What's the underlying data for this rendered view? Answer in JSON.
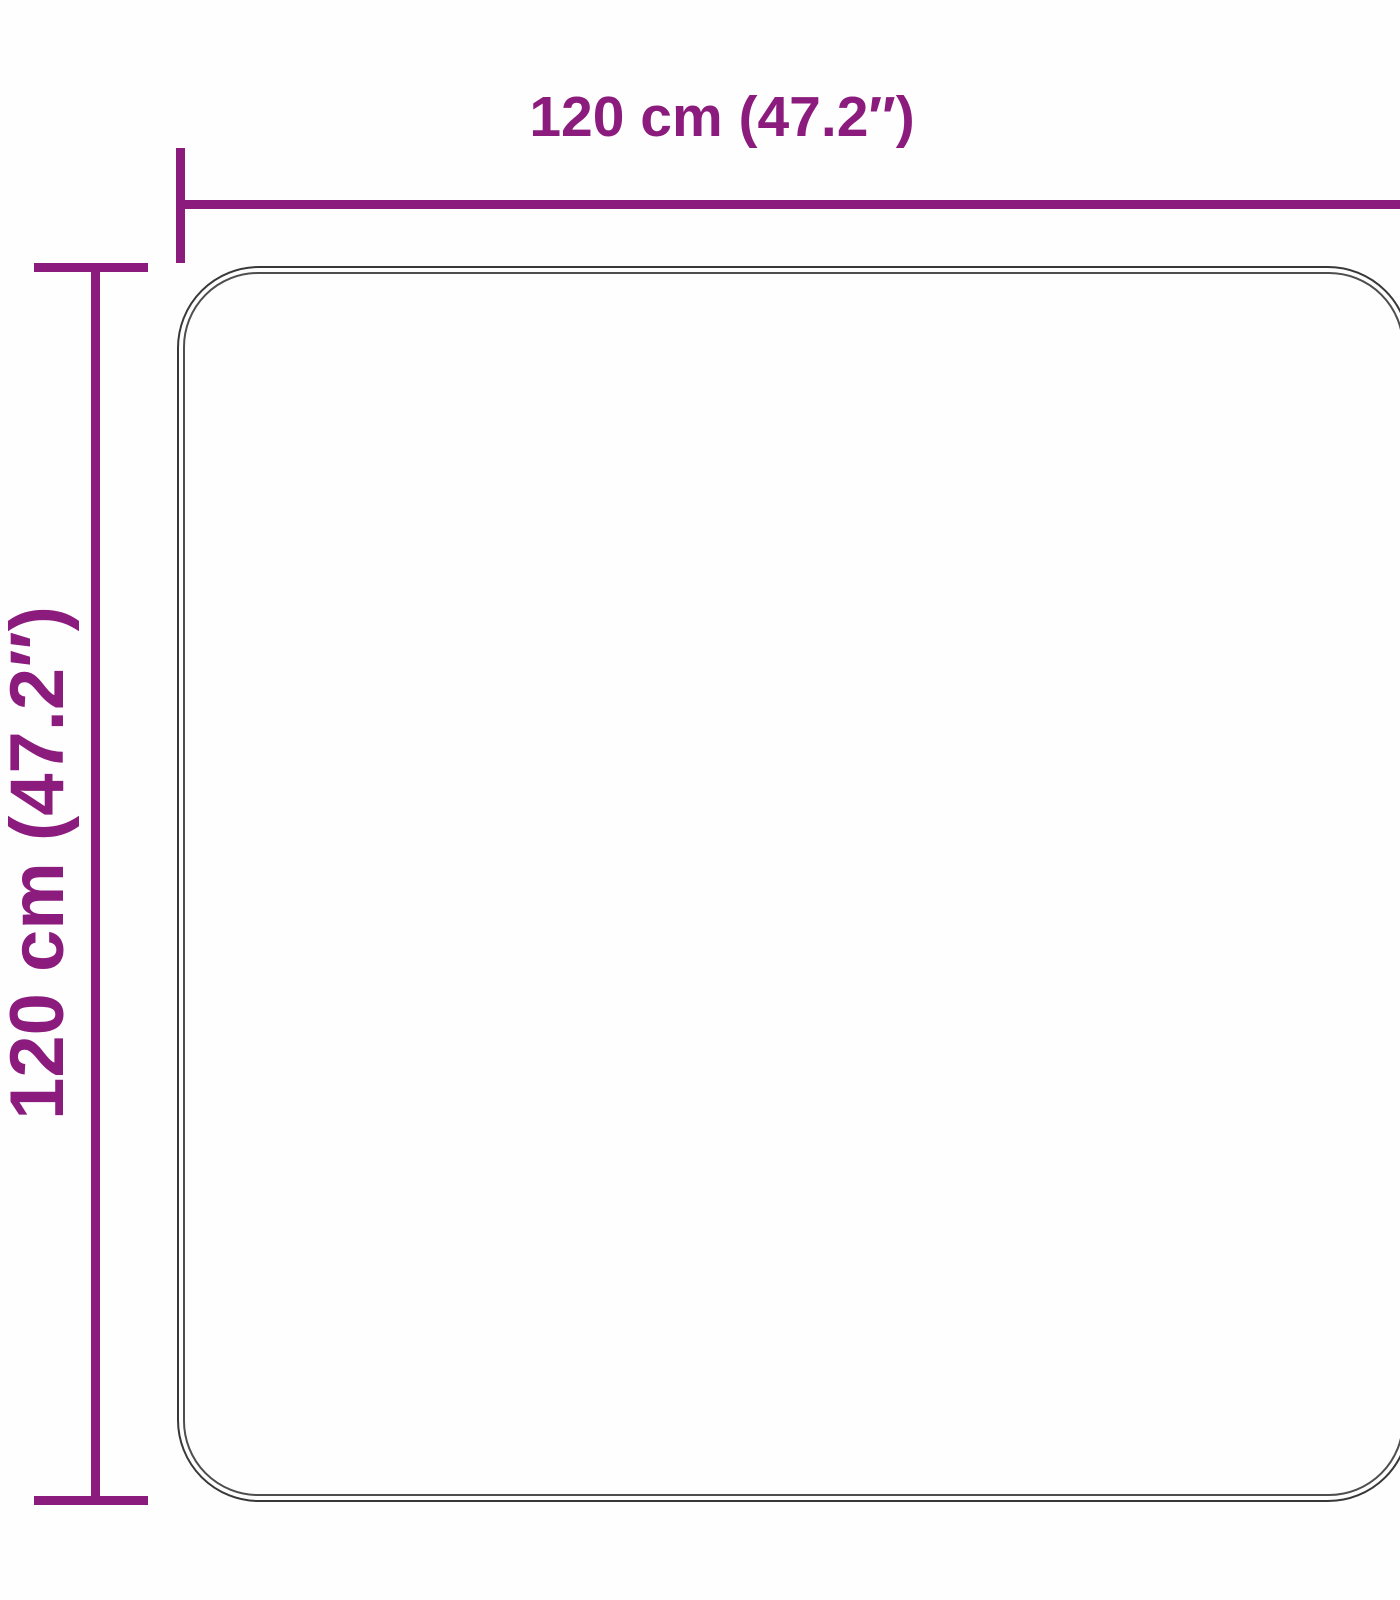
{
  "diagram": {
    "type": "product-dimension-diagram",
    "product_shape": "square rug with rounded corners",
    "width_label": "120 cm (47.2″)",
    "height_label": "120 cm (47.2″)",
    "accent_color": "#8b1b7d",
    "outline_outer_color": "#383838",
    "outline_inner_color": "#4e4e4e"
  }
}
